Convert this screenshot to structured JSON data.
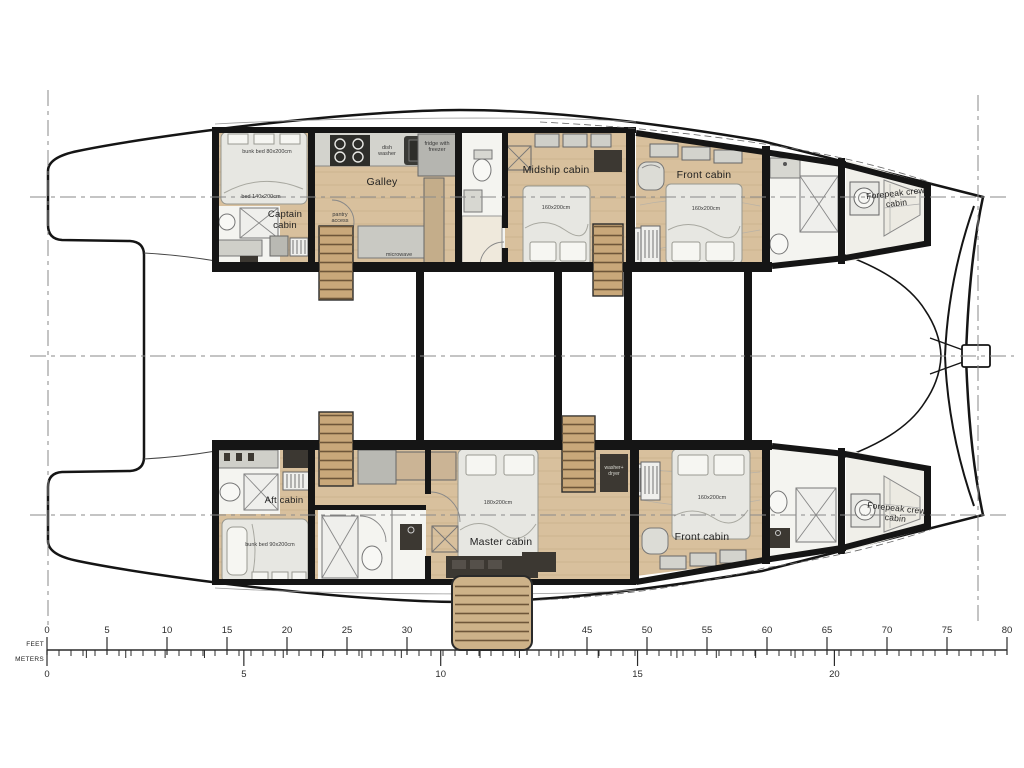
{
  "boat": {
    "rooms": {
      "captain": "Captain cabin",
      "galley": "Galley",
      "midship": "Midship cabin",
      "front_top": "Front cabin",
      "forepeak_top": "Forepeak crew cabin",
      "aft": "Aft cabin",
      "master": "Master cabin",
      "front_bottom": "Front cabin",
      "forepeak_bottom": "Forepeak crew cabin"
    },
    "annotations": {
      "bunk80": "bunk bed 80x200cm",
      "bed140": "bed 140x200cm",
      "dishwasher": "dish washer",
      "fridge": "fridge with freezer",
      "pantry": "pantry access",
      "microwave": "microwave",
      "dim_midship": "160x200cm",
      "dim_front_top": "160x200cm",
      "bunk90": "bunk bed 90x200cm",
      "dim_master": "180x200cm",
      "washer_dryer": "washer+ dryer",
      "dim_front_bottom": "160x200cm"
    }
  },
  "scale": {
    "unit_top": "FEET",
    "unit_bottom": "METERS",
    "feet_labels": [
      0,
      5,
      10,
      15,
      20,
      25,
      30,
      35,
      40,
      45,
      50,
      55,
      60,
      65,
      70,
      75,
      80
    ],
    "meters_labels": [
      0,
      5,
      10,
      15,
      20
    ],
    "feet_max": 80,
    "feet_minor_step": 1,
    "feet_label_step": 5,
    "meters_max": 20,
    "meters_minor_step": 1,
    "meters_label_step": 5,
    "origin_x": 47,
    "px_per_foot": 12,
    "feet_per_meter": 3.28084,
    "baseline_y": 650
  },
  "colors": {
    "wall": "#151515",
    "wood_floor": "#d8c09d",
    "stairs_wood": "#c9a87a",
    "furniture_gray": "#d7d7d1",
    "cabinet_dark": "#3c3832",
    "bath_white": "#f4f4f0"
  }
}
